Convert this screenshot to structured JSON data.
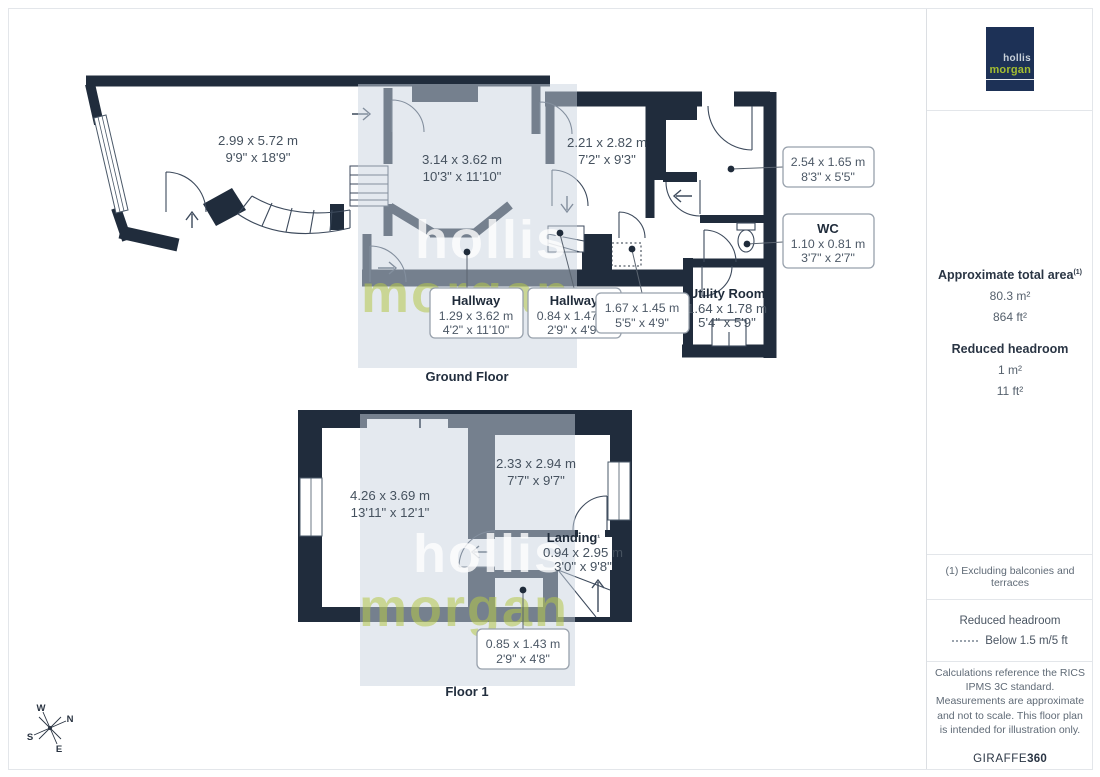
{
  "logo": {
    "line1": "hollis",
    "line2": "morgan"
  },
  "watermark": {
    "line1": "hollis",
    "line2": "morgan"
  },
  "compass": {
    "n": "N",
    "e": "E",
    "s": "S",
    "w": "W"
  },
  "colors": {
    "wall": "#202c3c",
    "band": "#c9d3e0",
    "logo_bg": "#1d3156",
    "logo_green": "#a4bd30"
  },
  "ground_floor": {
    "title": "Ground Floor",
    "room_main": {
      "dim_m": "2.99 x 5.72 m",
      "dim_ft": "9'9\" x 18'9\""
    },
    "room_central": {
      "dim_m": "3.14 x 3.62 m",
      "dim_ft": "10'3\" x 11'10\""
    },
    "room_right": {
      "dim_m": "2.21 x 2.82 m",
      "dim_ft": "7'2\" x 9'3\""
    },
    "room_utility": {
      "name": "Utility Room",
      "dim_m": "1.64 x 1.78 m",
      "dim_ft": "5'4\" x 5'9\""
    },
    "box_254": {
      "dim_m": "2.54 x 1.65 m",
      "dim_ft": "8'3\" x 5'5\""
    },
    "box_wc": {
      "name": "WC",
      "dim_m": "1.10 x 0.81 m",
      "dim_ft": "3'7\" x 2'7\""
    },
    "box_hall1": {
      "name": "Hallway",
      "dim_m": "1.29 x 3.62 m",
      "dim_ft": "4'2\" x 11'10\""
    },
    "box_hall2": {
      "name": "Hallway",
      "dim_m": "0.84 x 1.47 m",
      "dim_ft": "2'9\" x 4'9\""
    },
    "box_167": {
      "dim_m": "1.67 x 1.45 m",
      "dim_ft": "5'5\" x 4'9\""
    }
  },
  "floor1": {
    "title": "Floor 1",
    "room_main": {
      "dim_m": "4.26 x 3.69 m",
      "dim_ft": "13'11\" x 12'1\""
    },
    "room_right": {
      "dim_m": "2.33 x 2.94 m",
      "dim_ft": "7'7\" x 9'7\""
    },
    "room_landing": {
      "name": "Landing",
      "sup": "¹",
      "dim_m": "0.94 x 2.95 m",
      "dim_ft": "3'0\" x 9'8\""
    },
    "box_085": {
      "dim_m": "0.85 x 1.43 m",
      "dim_ft": "2'9\" x 4'8\""
    }
  },
  "sidebar": {
    "area_title": "Approximate total area",
    "area_ref": "(1)",
    "area_m": "80.3 m²",
    "area_ft": "864 ft²",
    "reduced_title": "Reduced headroom",
    "reduced_m": "1 m²",
    "reduced_ft": "11 ft²",
    "footnote": "(1) Excluding balconies and terraces",
    "legend_title": "Reduced headroom",
    "legend_item": "Below 1.5 m/5 ft",
    "disclaimer": "Calculations reference the RICS IPMS 3C standard. Measurements are approximate and not to scale. This floor plan is intended for illustration only.",
    "brand": "GIRAFFE",
    "brand_suffix": "360"
  }
}
